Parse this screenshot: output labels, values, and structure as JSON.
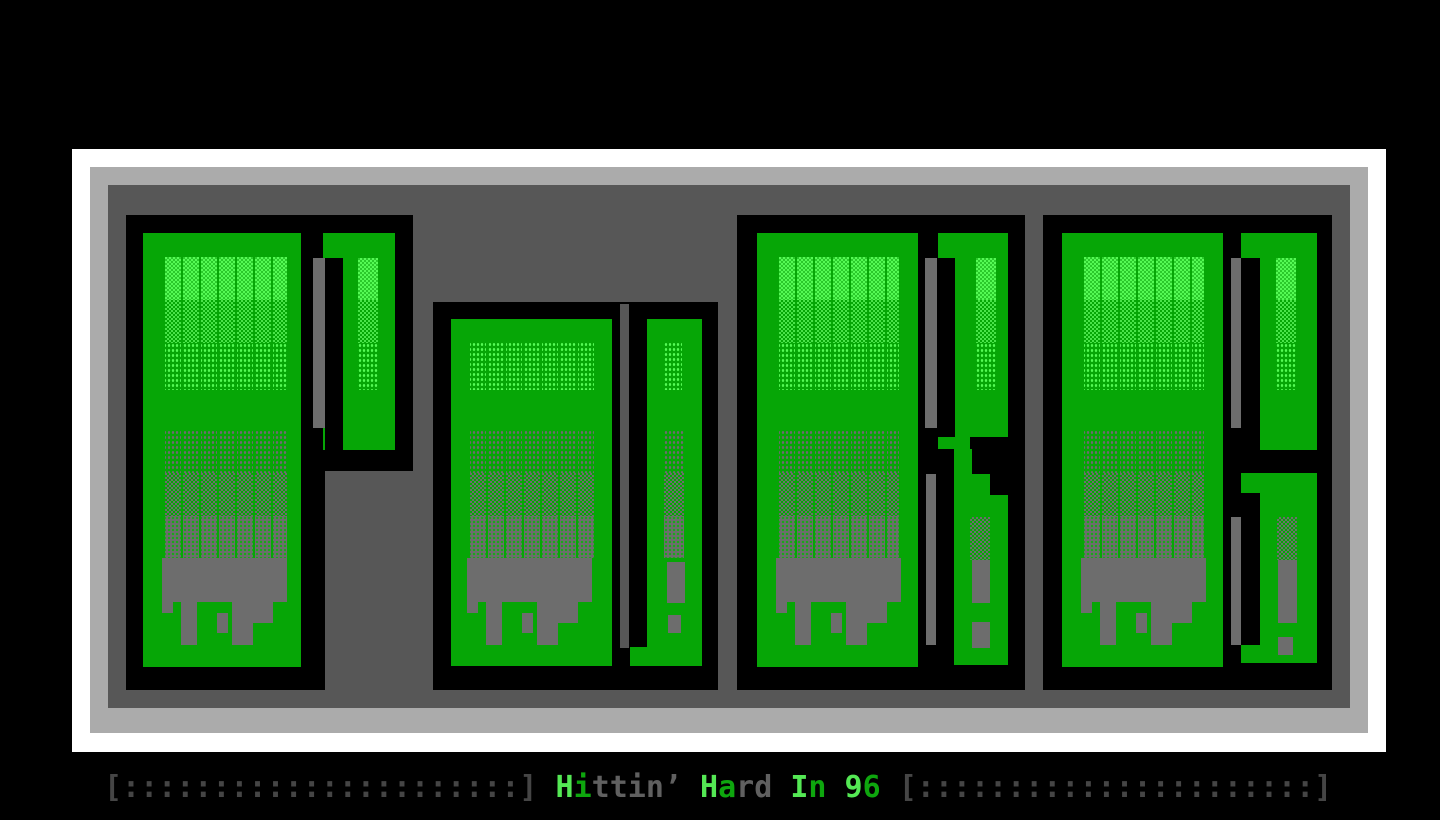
{
  "screen": {
    "width": 1440,
    "height": 820,
    "background": "#000000"
  },
  "palette": {
    "bg": "#000000",
    "ink": "#000000",
    "frame-white": "#ffffff",
    "frame-gray": "#ababab",
    "panel": "#575757",
    "green": "#06a606",
    "green-bright": "#55fa55",
    "shadow": "#6d6d6d",
    "caption-dim": "#454545",
    "caption-gray": "#606060",
    "caption-bright-green": "#54e854",
    "caption-green": "#0ea60e"
  },
  "artwork": {
    "word": "PuRE",
    "letters": [
      "P",
      "u",
      "R",
      "E"
    ],
    "style": "ANSI block letters with dither shading and gray melt shadow"
  },
  "caption": {
    "full_text": "[::::::::::::::::::::::] Hittin’ Hard In 96 [::::::::::::::::::::::]",
    "segments": [
      {
        "text": "[::::::::::::::::::::::] ",
        "color": "#454545"
      },
      {
        "text": "H",
        "color": "#54e854"
      },
      {
        "text": "i",
        "color": "#0ea60e"
      },
      {
        "text": "ttin’ ",
        "color": "#606060"
      },
      {
        "text": "H",
        "color": "#54e854"
      },
      {
        "text": "a",
        "color": "#0ea60e"
      },
      {
        "text": "rd ",
        "color": "#606060"
      },
      {
        "text": "I",
        "color": "#54e854"
      },
      {
        "text": "n",
        "color": "#0ea60e"
      },
      {
        "text": " ",
        "color": "#606060"
      },
      {
        "text": "9",
        "color": "#54e854"
      },
      {
        "text": "6",
        "color": "#0ea60e"
      },
      {
        "text": " [::::::::::::::::::::::]",
        "color": "#454545"
      }
    ]
  }
}
